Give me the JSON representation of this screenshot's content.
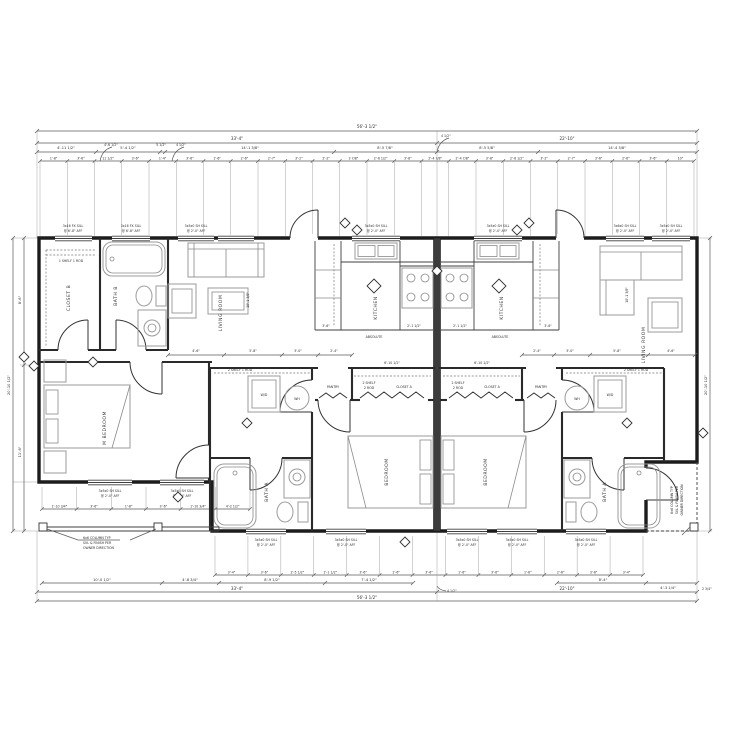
{
  "meta": {
    "drawing_type": "duplex floor plan"
  },
  "dims": {
    "top_overall": "56'-3 1/2\"",
    "top_len_left": "33'-4\"",
    "top_len_right": "22'-10\"",
    "top_seg": [
      "4'-11 1/2\"",
      "5'-4 1/2\"",
      "5 1/2\"",
      "14'-1 3/8\"",
      "8'-5 7/8\"",
      "8'-5 5/8\"",
      "14'-4 3/8\""
    ],
    "top_small": [
      "1'-8\"",
      "3'-6\"",
      "11 1/2\"",
      "3'-6\"",
      "1'-4\"",
      "3'-6\"",
      "1'-6\"",
      "2'-6\"",
      "2'-7\"",
      "3'-2\"",
      "2'-2\"",
      "3 7/8\"",
      "2'-6 1/2\"",
      "3'-8\"",
      "2'-4 7/8\"",
      "2'-4 7/8\"",
      "3'-8\"",
      "2'-6 1/2\"",
      "3'-2\"",
      "2'-7\"",
      "3'-6\"",
      "2'-6\"",
      "3'-6\"",
      "10\""
    ],
    "callout_a": "4'-6 1/2\"",
    "callout_b": "4 1/2\"",
    "callout_center": "4 1/2\"",
    "callout_bottom": "4 1/2\"",
    "bot_overall": "56'-3 1/2\"",
    "bot_len_left": "33'-4\"",
    "bot_len_right": "22'-10\"",
    "bot_mid": [
      "10'-0 1/2\"",
      "4'-8 3/4\"",
      "8'-9 1/2\"",
      "7'-4 1/2\"",
      "8'-4\"",
      "4'-3 1/4\""
    ],
    "bot_small": [
      "3'-4\"",
      "3'-6\"",
      "2'-5 1/2\"",
      "1'-1 1/2\"",
      "3'-6\"",
      "1'-6\"",
      "3'-6\"",
      "1'-6\"",
      "3'-6\"",
      "1'-6\"",
      "2'-6\"",
      "3'-6\"",
      "3'-4\""
    ],
    "bot_small_left": [
      "1'-10 3/4\"",
      "3'-6\"",
      "1'-8\"",
      "3'-6\"",
      "1'-10 3/4\"",
      "4'-2 1/2\""
    ],
    "corner": "2 3/4\"",
    "left_a": "8'-6\"",
    "left_b": "11'-6\"",
    "left_total": "20'-10 1/2\"",
    "right_total": "20'-10 1/2\"",
    "hall_left": [
      "4'-6\"",
      "5'-8\"",
      "3'-0\"",
      "2'-4\""
    ],
    "hall_right": [
      "2'-4\"",
      "3'-0\"",
      "5'-8\"",
      "4'-6\""
    ],
    "closet_l": "6'-10 1/2\"",
    "closet_r": "6'-10 1/2\"",
    "liv_l": "10'-1 3/8\"",
    "liv_r": "10'-1 3/8\"",
    "kit_a": "3'-6\"",
    "kit_b": "2'-1 1/2\"",
    "kit_c": "2'-1 1/2\"",
    "kit_d": "3'-6\""
  },
  "rooms": {
    "closet_b": "CLOSET B",
    "bath_b": "BATH B",
    "living": "LIVING ROOM",
    "kitchen": "KITCHEN",
    "m_bedroom": "M BEDROOM",
    "bedroom": "BEDROOM",
    "bath_a": "BATH A",
    "closet_a": "CLOSET A",
    "pantry": "PANTRY"
  },
  "labels": {
    "wh": "WH",
    "wd": "W/D",
    "absolute": "ABSOLUTE",
    "shelf1": "1 SHELF 1 ROD",
    "shelf2a": "2 SHELF",
    "shelf2b": "2 ROD",
    "shelf21": "2 SHELF 1 ROD"
  },
  "windows": {
    "fx": "3x16 FX SILL",
    "fx_h": "@ 6'-8\" AFF",
    "sh": "3x5x0 SH SILL",
    "sh_h": "@ 2'-0\" AFF",
    "sh36": "3x6x0 SH SILL"
  },
  "notes": {
    "col1": "6x6 COLUMN TYP",
    "col2": "SVL & FINISH PER",
    "col3": "OWNER DIRECTION"
  }
}
